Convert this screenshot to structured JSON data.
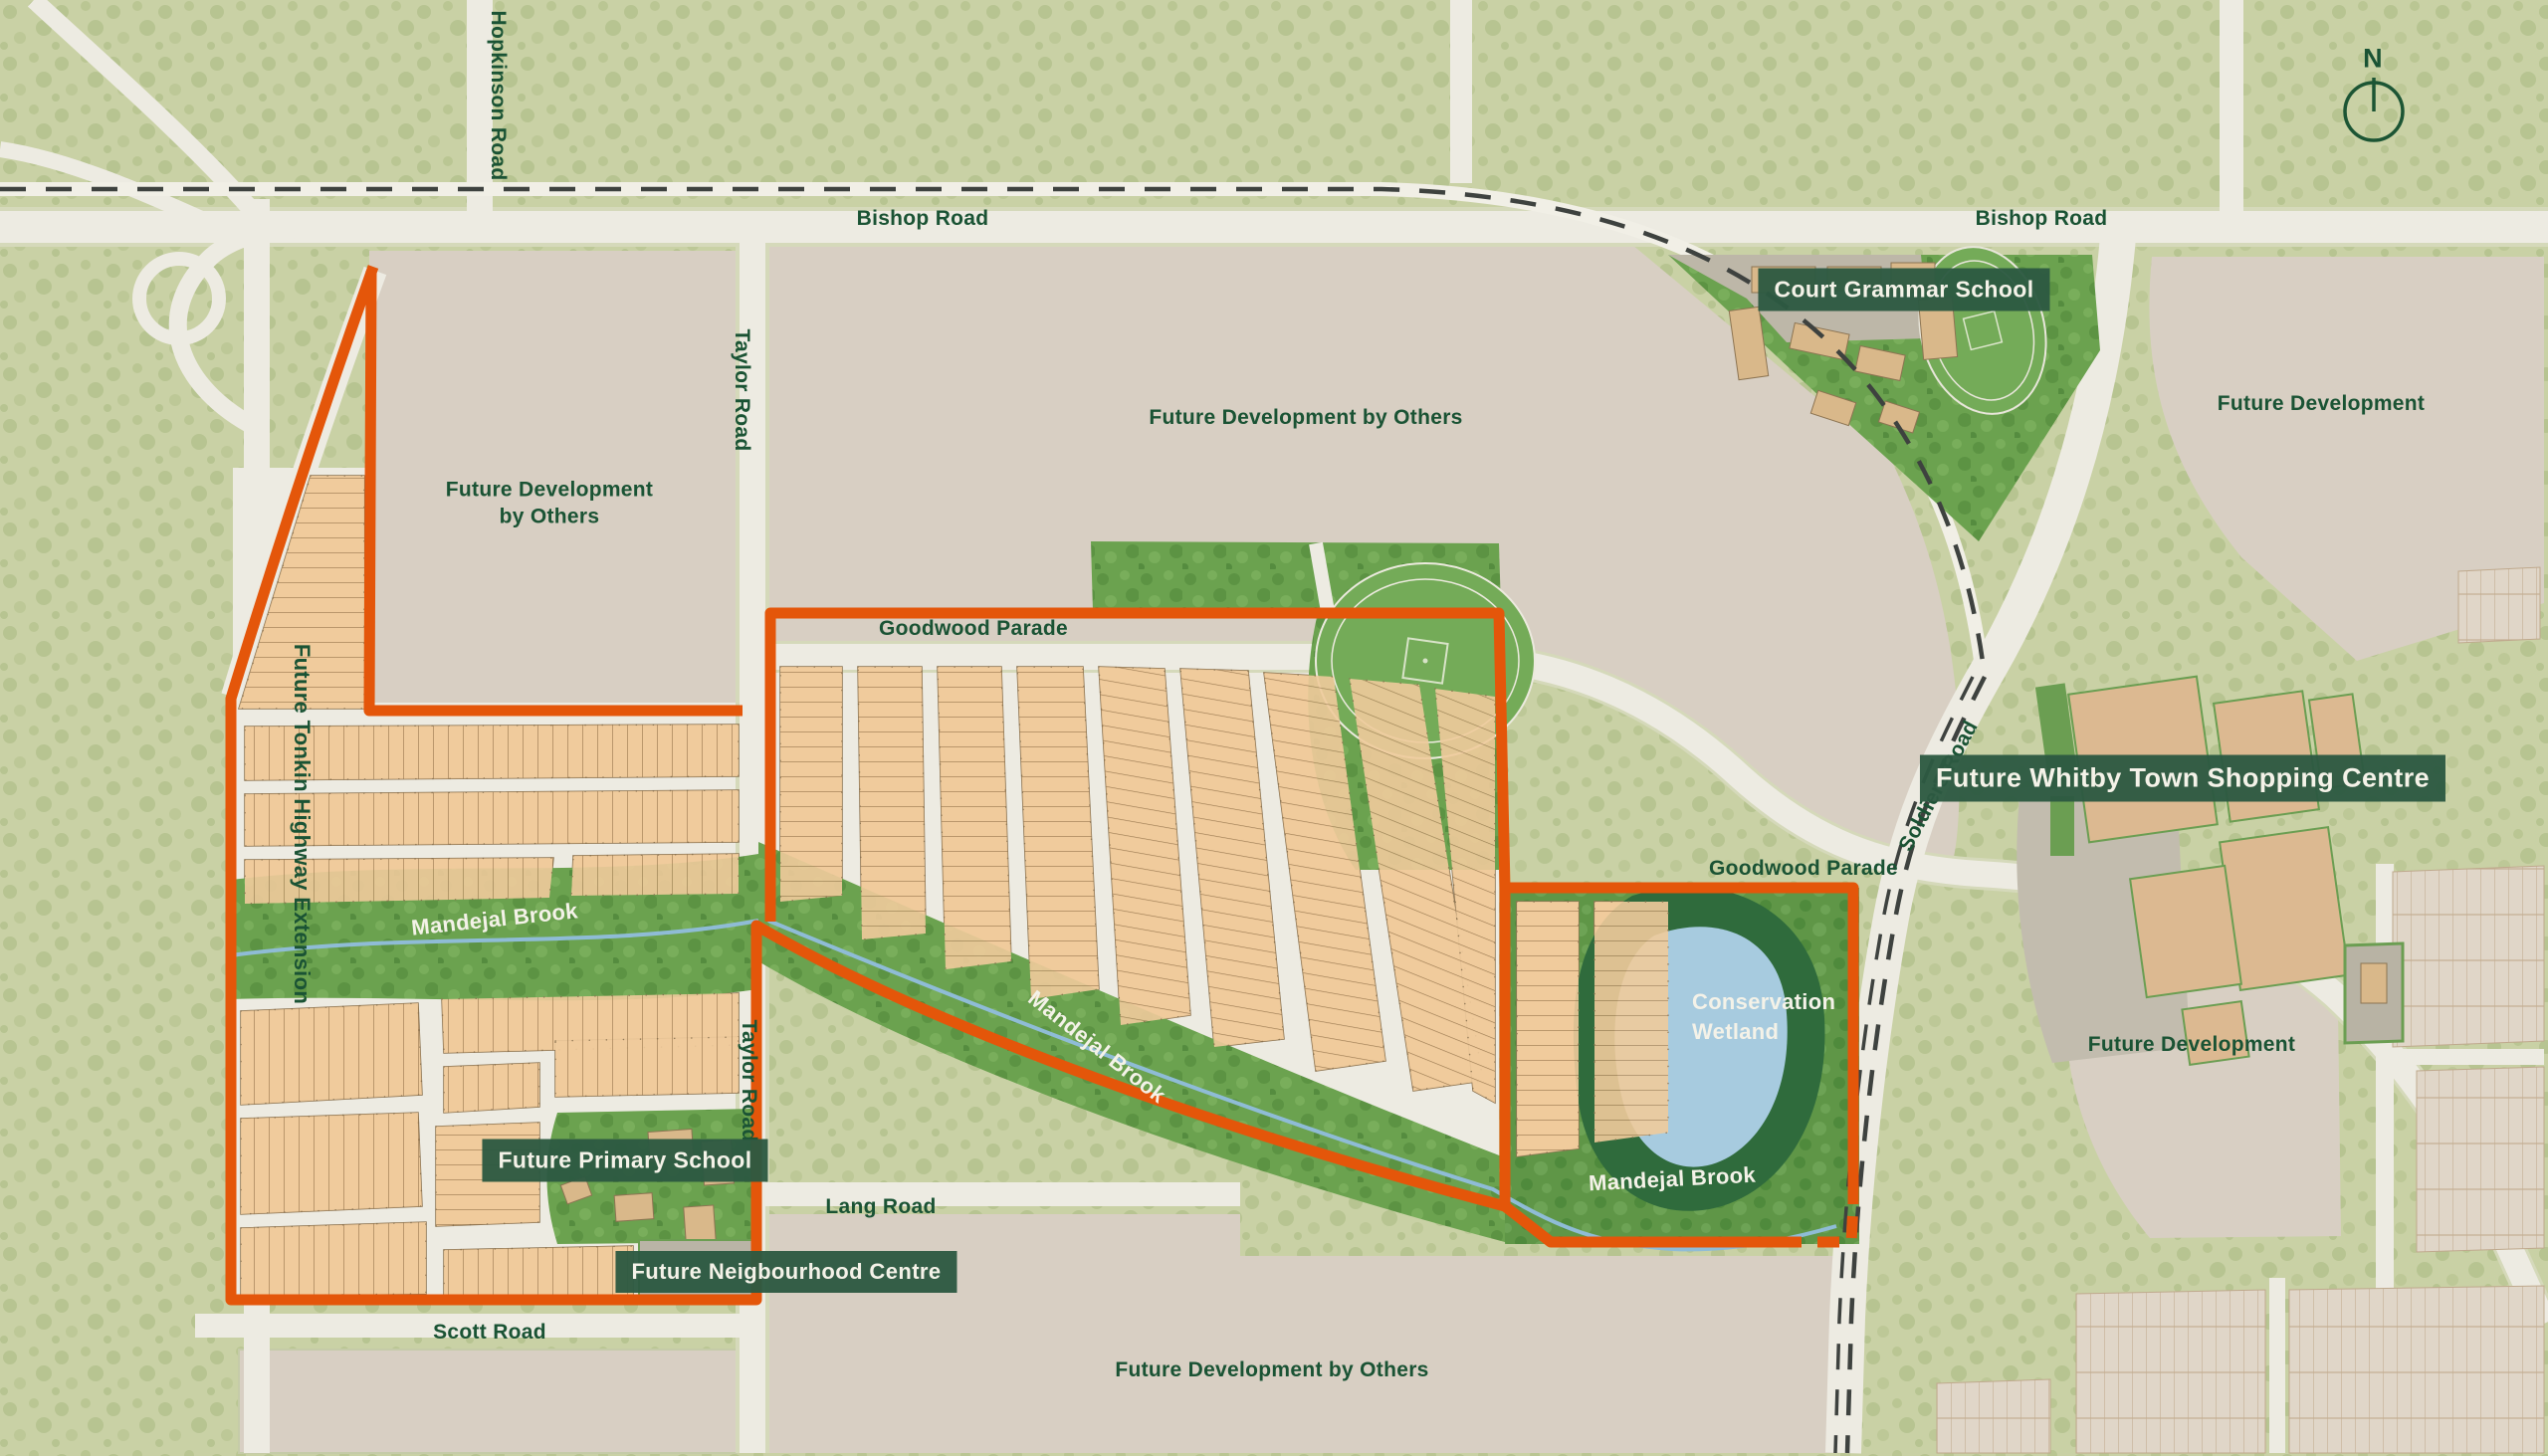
{
  "map": {
    "compass": "N",
    "roads": {
      "bishop_left": "Bishop Road",
      "bishop_right": "Bishop Road",
      "hopkinson": "Hopkinson Road",
      "taylor_top": "Taylor Road",
      "taylor_bottom": "Taylor Road",
      "tonkin": "Future Tonkin Highway Extension",
      "soldiers": "Soldiers Road",
      "goodwood_west": "Goodwood Parade",
      "goodwood_east": "Goodwood Parade",
      "lang": "Lang Road",
      "scott": "Scott Road"
    },
    "areas": {
      "fdo_topleft_line1": "Future Development",
      "fdo_topleft_line2": "by Others",
      "fdo_top": "Future Development by Others",
      "fdo_bottom": "Future Development by Others",
      "fd_right_top": "Future Development",
      "fd_right_lower": "Future Development"
    },
    "water": {
      "mandejal_west": "Mandejal Brook",
      "mandejal_central": "Mandejal Brook",
      "mandejal_east": "Mandejal Brook",
      "wetland_line1": "Conservation",
      "wetland_line2": "Wetland"
    },
    "badges": {
      "court_grammar": "Court Grammar School",
      "whitby": "Future Whitby Town Shopping Centre",
      "primary_school": "Future Primary School",
      "neighbourhood_centre": "Future Neigbourhood Centre"
    }
  },
  "colors": {
    "boundary_orange": "#e4560a",
    "badge_green": "#2e5c44",
    "label_green": "#1a5334",
    "wetland_blue": "#a7cbdf",
    "estate_green": "#6ba24f",
    "lot_tan": "#f0cb9c"
  }
}
